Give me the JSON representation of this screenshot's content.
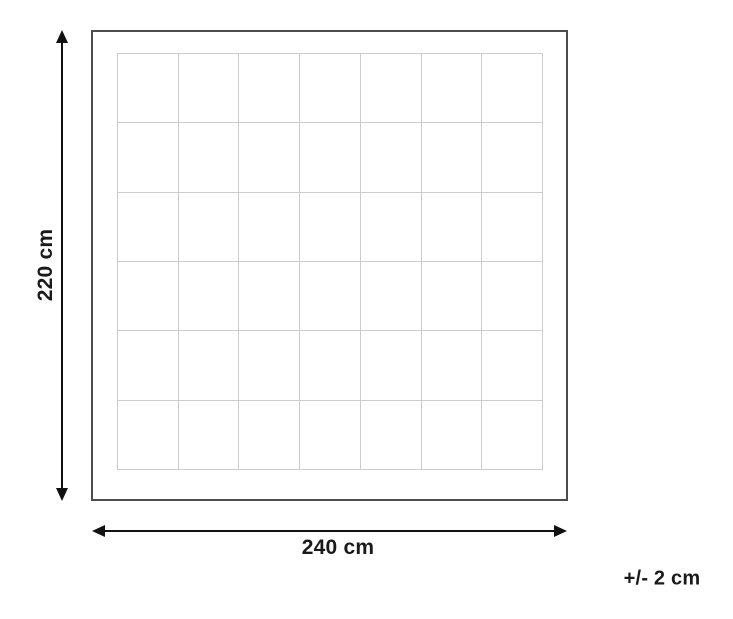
{
  "diagram": {
    "type": "product-dimensions",
    "height_label": "220 cm",
    "width_label": "240 cm",
    "tolerance_label": "+/- 2 cm",
    "grid": {
      "columns": 7,
      "rows": 6
    },
    "colors": {
      "outline": "#4d4d4d",
      "grid_line": "#cccccc",
      "arrow": "#111111",
      "background": "#ffffff",
      "text": "#1a1a1a"
    }
  }
}
